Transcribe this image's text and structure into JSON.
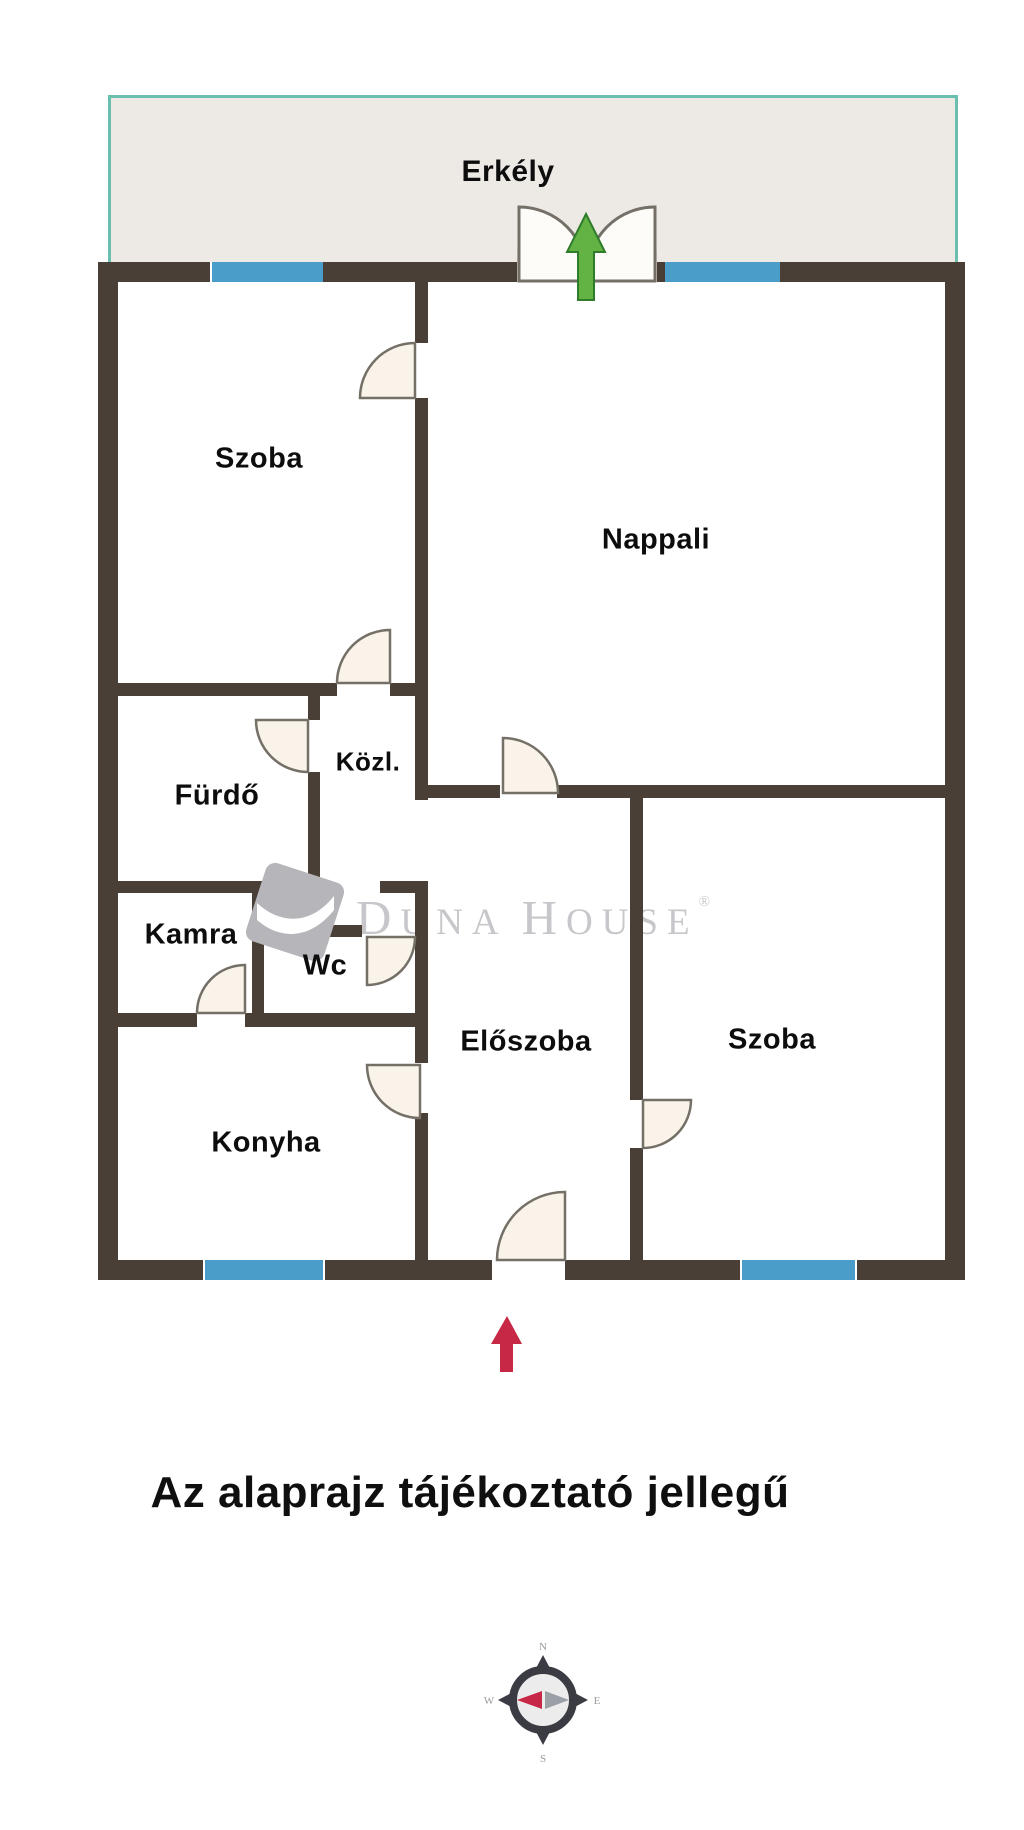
{
  "plan": {
    "labels": {
      "erkely": "Erkély",
      "szoba1": "Szoba",
      "nappali": "Nappali",
      "furdo": "Fürdő",
      "kozl": "Közl.",
      "kamra": "Kamra",
      "wc": "Wc",
      "eloszoba": "Előszoba",
      "szoba2": "Szoba",
      "konyha": "Konyha"
    },
    "watermark": {
      "part1": "D",
      "part2": "UNA",
      "part3": "H",
      "part4": "OUSE",
      "registered": "®"
    },
    "colors": {
      "wall": "#493f37",
      "window": "#4a9dc9",
      "balcony_fill": "#edeae6",
      "balcony_border": "#6abfae",
      "door_fill": "#faf3e9",
      "door_stroke": "#757067",
      "north_arrow_red": "#c62846",
      "balcony_arrow_green": "#63b244",
      "watermark_gray": "#c7c7cb"
    }
  },
  "caption": "Az alaprajz tájékoztató jellegű",
  "compass": {
    "n": "N",
    "e": "E",
    "s": "S",
    "w": "W"
  }
}
